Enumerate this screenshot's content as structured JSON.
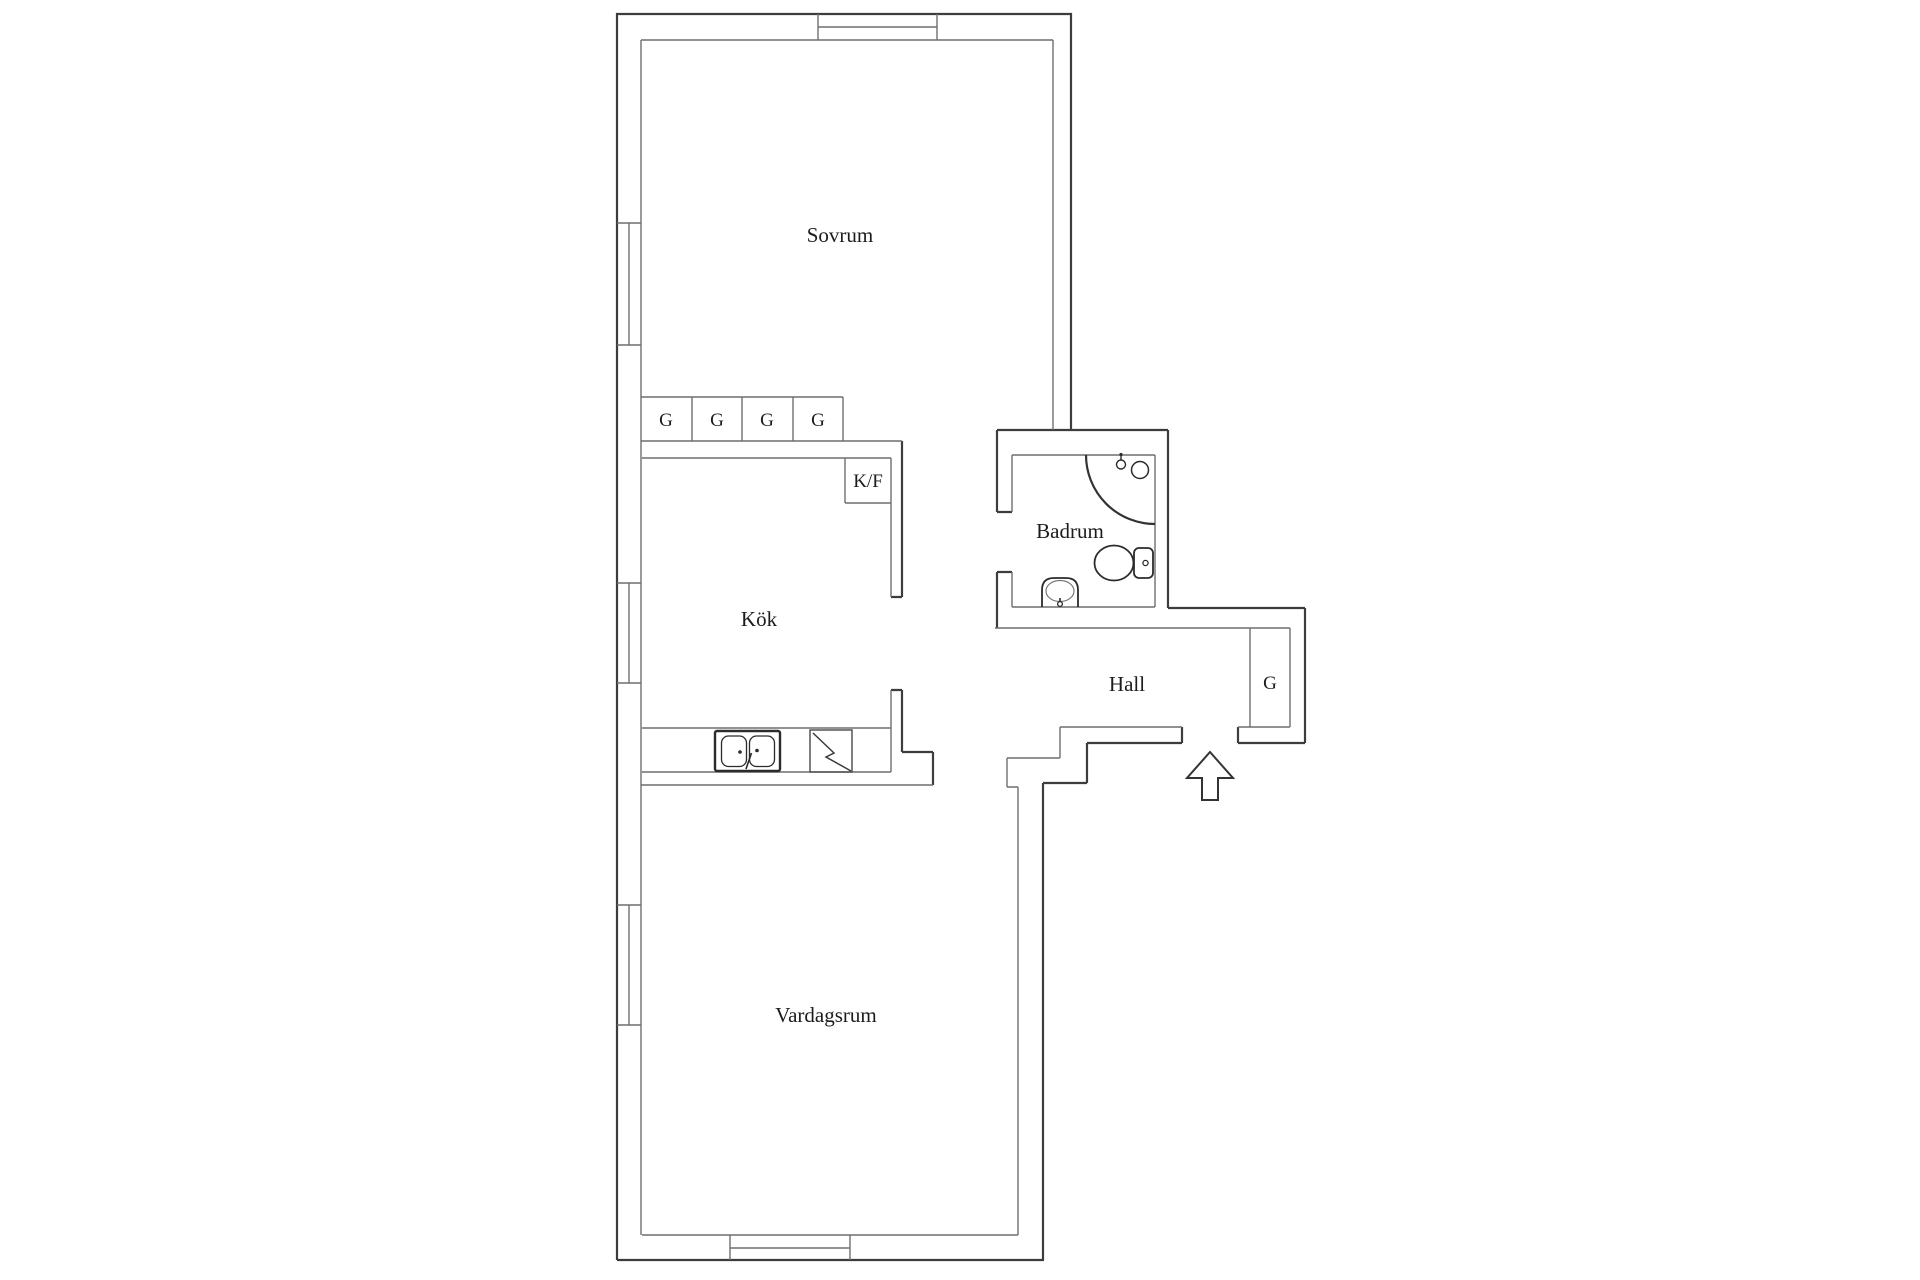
{
  "floor_plan": {
    "background_color": "#ffffff",
    "outer_wall_color": "#3d3d3d",
    "inner_wall_color": "#6f6f6f",
    "fixture_color": "#2b2b2b",
    "text_color": "#1c1c1c",
    "rooms": [
      {
        "id": "sovrum",
        "label": "Sovrum"
      },
      {
        "id": "kok",
        "label": "Kök"
      },
      {
        "id": "badrum",
        "label": "Badrum"
      },
      {
        "id": "hall",
        "label": "Hall"
      },
      {
        "id": "vardagsrum",
        "label": "Vardagsrum"
      }
    ],
    "bedroom_wardrobes": [
      {
        "label": "G"
      },
      {
        "label": "G"
      },
      {
        "label": "G"
      },
      {
        "label": "G"
      }
    ],
    "hall_wardrobe": {
      "label": "G"
    },
    "kitchen_appliance_box": {
      "label": "K/F"
    },
    "icons": [
      "window-icon",
      "double-sink-icon",
      "stove-icon",
      "shower-corner-icon",
      "round-basin-icon",
      "shower-head-icon",
      "toilet-icon",
      "washbasin-icon",
      "entrance-arrow-icon"
    ]
  }
}
